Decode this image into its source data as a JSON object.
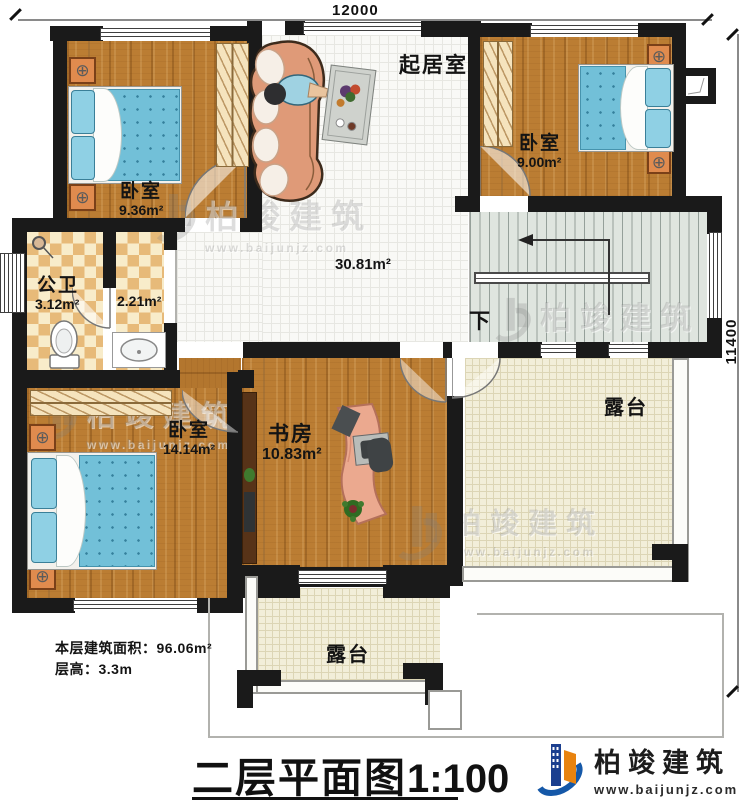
{
  "dimensions": {
    "top": "12000",
    "right": "11400"
  },
  "rooms": {
    "bedroom_tl": {
      "label": "卧室",
      "area": "9.36m²"
    },
    "bedroom_tr": {
      "label": "卧室",
      "area": "9.00m²"
    },
    "living": {
      "label": "起居室",
      "area": "30.81m²"
    },
    "bathroom": {
      "label": "公卫",
      "area": "3.12m²"
    },
    "washroom": {
      "area": "2.21m²"
    },
    "bedroom_bl": {
      "label": "卧室",
      "area": "14.14m²"
    },
    "study": {
      "label": "书房",
      "area": "10.83m²"
    },
    "terrace_right": {
      "label": "露台"
    },
    "terrace_bottom": {
      "label": "露台"
    },
    "stairs": {
      "direction_label": "下"
    }
  },
  "info": {
    "building_area": "本层建筑面积：96.06m²",
    "floor_height": "层高：3.3m"
  },
  "title": {
    "main": "二层平面图",
    "scale": "1:100"
  },
  "brand": {
    "name": "柏竣建筑",
    "url": "www.baijunjz.com"
  },
  "watermark": {
    "name": "柏竣建筑",
    "url": "www.baijunjz.com"
  }
}
